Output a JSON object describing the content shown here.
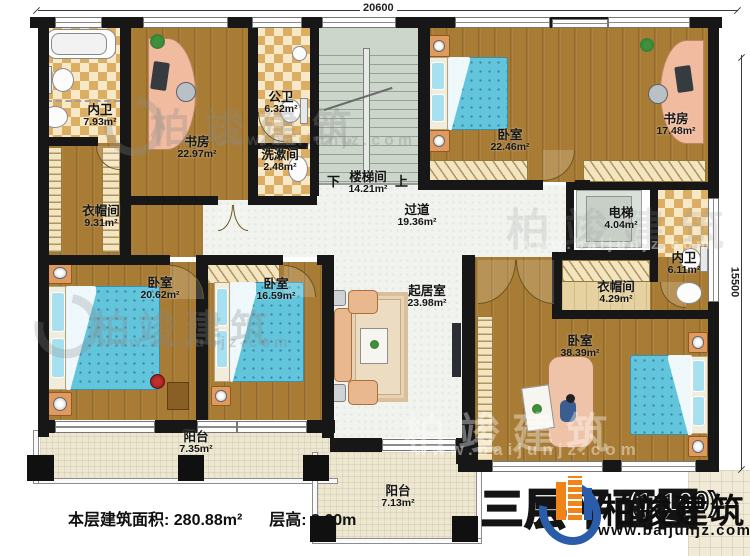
{
  "dimensions": {
    "width_top": "20600",
    "height_right": "15500"
  },
  "rooms": [
    {
      "name": "内卫",
      "area": "7.93m²"
    },
    {
      "name": "书房",
      "area": "22.97m²"
    },
    {
      "name": "公卫",
      "area": "6.32m²"
    },
    {
      "name": "洗漱间",
      "area": "2.48m²"
    },
    {
      "name": "楼梯间",
      "area": "14.21m²"
    },
    {
      "name": "卧室",
      "area": "22.46m²"
    },
    {
      "name": "书房",
      "area": "17.48m²"
    },
    {
      "name": "衣帽间",
      "area": "9.31m²"
    },
    {
      "name": "过道",
      "area": "19.36m²"
    },
    {
      "name": "电梯",
      "area": "4.04m²"
    },
    {
      "name": "内卫",
      "area": "6.11m²"
    },
    {
      "name": "卧室",
      "area": "20.62m²"
    },
    {
      "name": "卧室",
      "area": "16.59m²"
    },
    {
      "name": "起居室",
      "area": "23.98m²"
    },
    {
      "name": "衣帽间",
      "area": "4.29m²"
    },
    {
      "name": "卧室",
      "area": "38.39m²"
    },
    {
      "name": "阳台",
      "area": "7.35m²"
    },
    {
      "name": "阳台",
      "area": "7.13m²"
    }
  ],
  "stairs": {
    "down": "下",
    "up": "上"
  },
  "footer": {
    "floor_area": "本层建筑面积: 280.88m²",
    "floor_height": "层高: 3.60m"
  },
  "title": {
    "plan": "三层平面图",
    "scale": "(1:100)"
  },
  "brand": {
    "name": "柏竣建筑",
    "url": "www.baijunjz.com"
  }
}
